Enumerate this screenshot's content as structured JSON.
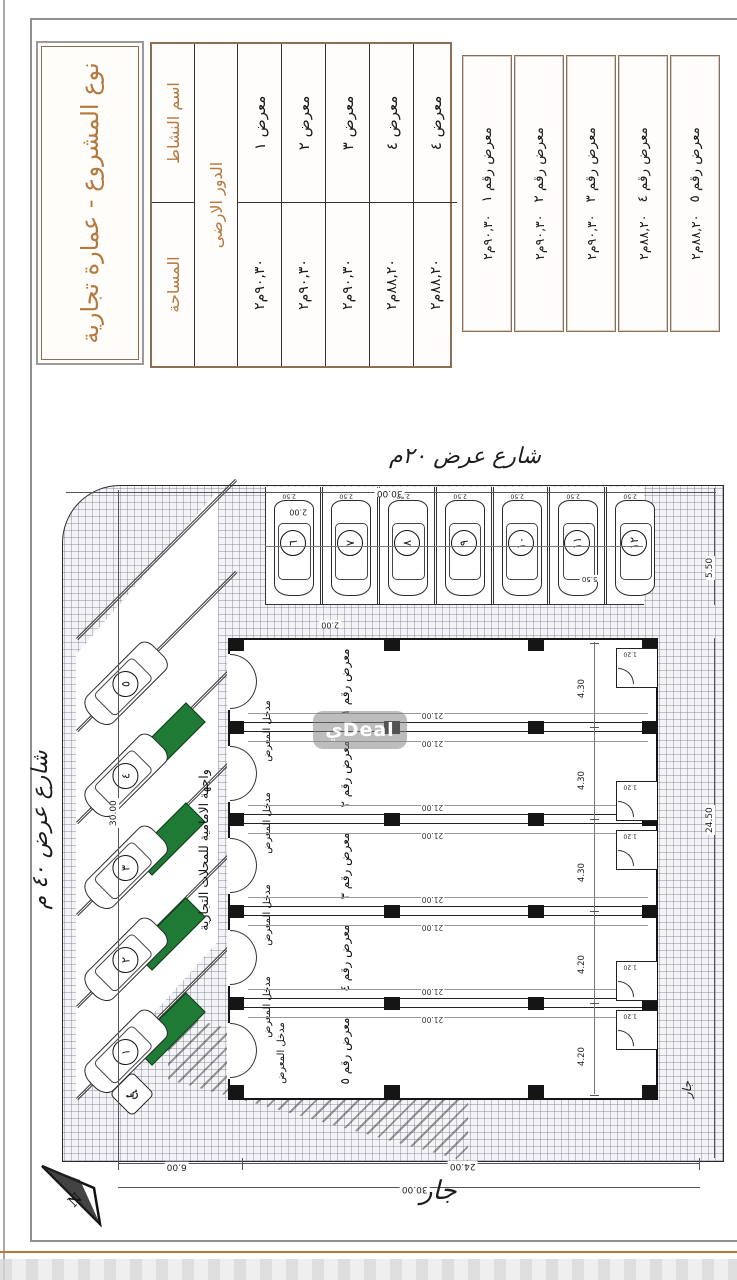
{
  "title_block": {
    "project_type": "نوع المشروع - عمارة تجارية"
  },
  "table": {
    "col_activity": "اسم النشاط",
    "col_area": "المساحة",
    "floor_header": "الدور الارضى",
    "rows": [
      {
        "name": "معرض ١",
        "area": "٩٠,٣٠م٢"
      },
      {
        "name": "معرض ٢",
        "area": "٩٠,٣٠م٢"
      },
      {
        "name": "معرض ٣",
        "area": "٩٠,٣٠م٢"
      },
      {
        "name": "معرض ٤",
        "area": "٨٨,٢٠م٢"
      },
      {
        "name": "معرض ٤",
        "area": "٨٨,٢٠م٢"
      }
    ]
  },
  "unit_cards": [
    {
      "name": "معرض رقم ١",
      "area": "٩٠,٣٠م٢"
    },
    {
      "name": "معرض رقم ٢",
      "area": "٩٠,٣٠م٢"
    },
    {
      "name": "معرض رقم ٣",
      "area": "٩٠,٣٠م٢"
    },
    {
      "name": "معرض رقم ٤",
      "area": "٨٨,٢٠م٢"
    },
    {
      "name": "معرض رقم ٥",
      "area": "٨٨,٢٠م٢"
    }
  ],
  "plan": {
    "street_top": "شارع عرض ٤٠ م",
    "street_right": "شارع عرض ٢٠م",
    "neighbor_left": "جار",
    "neighbor_bottom": "جار",
    "facade_note": "واجهة الامامية للمحلات التجارية",
    "entrance_label": "مدخل المعرض",
    "bay_length": "21.00",
    "wc_width": "1.20",
    "north": "N",
    "bays": [
      {
        "label": "معرض رقم ١",
        "width": "4.30"
      },
      {
        "label": "معرض رقم ٢",
        "width": "4.30"
      },
      {
        "label": "معرض رقم ٣",
        "width": "4.30"
      },
      {
        "label": "معرض رقم ٤",
        "width": "4.20"
      },
      {
        "label": "معرض رقم ٥",
        "width": "4.20"
      }
    ],
    "dims": {
      "site_right": "30.00",
      "site_top": "30.00",
      "left_a": "6.00",
      "left_b": "24.00",
      "left_total": "30.00",
      "bottom_building": "24.50",
      "bottom_parking": "5.50",
      "setback": "2.00",
      "walkway": "2.00",
      "stall_width": "2.50",
      "stall_depth": "5.50"
    },
    "parking": {
      "angled": [
        "١",
        "٢",
        "٣",
        "٤",
        "٥"
      ],
      "perpendicular": [
        "٦",
        "٧",
        "٨",
        "٩",
        "١٠",
        "١١",
        "١٢"
      ],
      "accessible_icon": "♿"
    }
  },
  "watermark": "يDeal"
}
